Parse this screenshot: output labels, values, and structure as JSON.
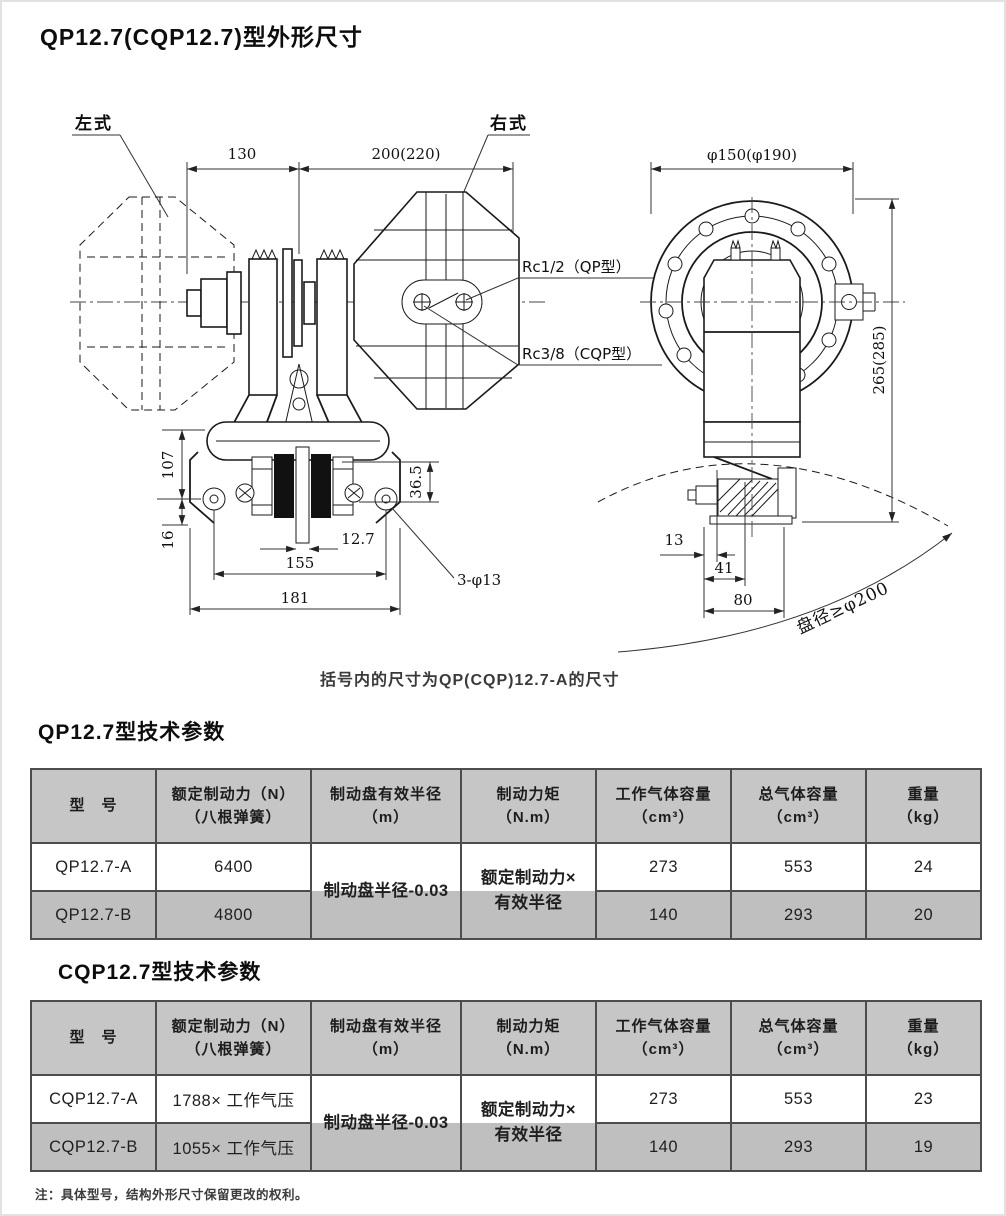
{
  "page": {
    "title": "QP12.7(CQP12.7)型外形尺寸",
    "caption": "括号内的尺寸为QP(CQP)12.7-A的尺寸",
    "footnote": "注：具体型号，结构外形尺寸保留更改的权利。"
  },
  "colors": {
    "table_header_bg": "#c6c6c6",
    "table_alt_row_bg": "#bfbfbf",
    "line_color": "#1a1a1a"
  },
  "drawing": {
    "front_view": {
      "label_left": "左式",
      "label_right": "右式",
      "dim_width_left": "130",
      "dim_width_right": "200(220)",
      "dim_height": "107",
      "dim_bottom": "16",
      "dim_pad": "36.5",
      "dim_disc": "12.7",
      "dim_span": "155",
      "dim_total": "181",
      "hole_note": "3-φ13",
      "port_qp": "Rc1/2（QP型）",
      "port_cqp": "Rc3/8（CQP型）"
    },
    "side_view": {
      "dim_flange": "φ150(φ190)",
      "dim_height": "265(285)",
      "dim_a": "13",
      "dim_b": "41",
      "dim_c": "80",
      "disc_note": "盘径≥φ200"
    }
  },
  "tables": [
    {
      "title": "QP12.7型技术参数",
      "headers": {
        "model": "型　号",
        "force1": "额定制动力（N）",
        "force2": "（八根弹簧）",
        "radius1": "制动盘有效半径",
        "radius2": "（m）",
        "torque1": "制动力矩",
        "torque2": "（N.m）",
        "work1": "工作气体容量",
        "work2": "（cm³）",
        "total1": "总气体容量",
        "total2": "（cm³）",
        "weight1": "重量",
        "weight2": "（kg）"
      },
      "radius_value": "制动盘半径-0.03",
      "torque_value1": "额定制动力×",
      "torque_value2": "有效半径",
      "rows": [
        {
          "model": "QP12.7-A",
          "force": "6400",
          "work": "273",
          "total": "553",
          "weight": "24"
        },
        {
          "model": "QP12.7-B",
          "force": "4800",
          "work": "140",
          "total": "293",
          "weight": "20"
        }
      ]
    },
    {
      "title": "CQP12.7型技术参数",
      "headers": {
        "model": "型　号",
        "force1": "额定制动力（N）",
        "force2": "（八根弹簧）",
        "radius1": "制动盘有效半径",
        "radius2": "（m）",
        "torque1": "制动力矩",
        "torque2": "（N.m）",
        "work1": "工作气体容量",
        "work2": "（cm³）",
        "total1": "总气体容量",
        "total2": "（cm³）",
        "weight1": "重量",
        "weight2": "（kg）"
      },
      "radius_value": "制动盘半径-0.03",
      "torque_value1": "额定制动力×",
      "torque_value2": "有效半径",
      "rows": [
        {
          "model": "CQP12.7-A",
          "force": "1788× 工作气压",
          "work": "273",
          "total": "553",
          "weight": "23"
        },
        {
          "model": "CQP12.7-B",
          "force": "1055× 工作气压",
          "work": "140",
          "total": "293",
          "weight": "19"
        }
      ]
    }
  ]
}
